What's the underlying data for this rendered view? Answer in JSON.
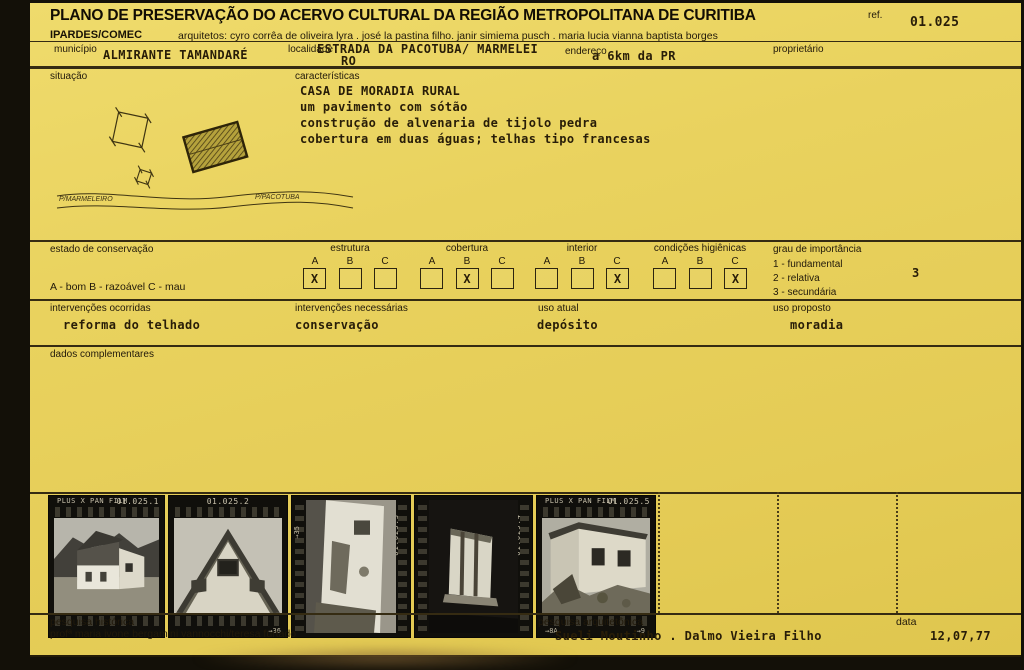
{
  "header": {
    "title": "PLANO DE PRESERVAÇÃO DO ACERVO CULTURAL DA REGIÃO METROPOLITANA DE CURITIBA",
    "org": "IPARDES/COMEC",
    "architects": "arquitetos: cyro corrêa de oliveira lyra . josé la pastina filho. janir simiema pusch . maria lucia vianna baptista borges",
    "ref_label": "ref.",
    "ref_value": "01.025"
  },
  "identification": {
    "municipio_label": "município",
    "municipio_value": "ALMIRANTE TAMANDARÉ",
    "localidade_label": "localidade",
    "localidade_value_line1": "ESTRADA DA PACOTUBA/ MARMELEI",
    "localidade_value_line2": "RO",
    "endereco_label": "endereço",
    "endereco_value": "a 6km da PR",
    "proprietario_label": "proprietário"
  },
  "situacao": {
    "label": "situação",
    "road_label_left": "P/MARMELEIRO",
    "road_label_right": "P/PACOTUBA"
  },
  "caracteristicas": {
    "label": "características",
    "lines": [
      "CASA DE MORADIA RURAL",
      "um pavimento com sótão",
      "construção de alvenaria de tijolo pedra",
      "cobertura em duas águas; telhas tipo francesas"
    ]
  },
  "conservation": {
    "section_label": "estado de conservação",
    "legend": "A - bom    B - razoável    C - mau",
    "options": [
      "A",
      "B",
      "C"
    ],
    "check_mark": "X",
    "groups": [
      {
        "name": "estrutura",
        "checked": "A"
      },
      {
        "name": "cobertura",
        "checked": "B"
      },
      {
        "name": "interior",
        "checked": "C"
      },
      {
        "name": "condições higiênicas",
        "checked": "C"
      }
    ],
    "importance": {
      "label": "grau de importância",
      "items": [
        "1 - fundamental",
        "2 - relativa",
        "3 - secundária"
      ],
      "value": "3"
    }
  },
  "interventions": {
    "occurred_label": "intervenções ocorridas",
    "occurred_value": "reforma do telhado",
    "needed_label": "intervenções necessárias",
    "needed_value": "conservação",
    "current_use_label": "uso atual",
    "current_use_value": "depósito",
    "proposed_use_label": "uso proposto",
    "proposed_use_value": "moradia"
  },
  "complementary": {
    "label": "dados complementares"
  },
  "photos": [
    {
      "label": "01.025.1",
      "film_text": "PLUS X PAN FILM"
    },
    {
      "label": "01.025.2",
      "mark_right": "→36"
    },
    {
      "label": "01.025.3",
      "edge_mark": "→35"
    },
    {
      "label": "01.025.4"
    },
    {
      "label": "01.025.5",
      "film_text": "PLUS X PAN FILM",
      "mark_left": "→8A",
      "mark_right": "→9"
    }
  ],
  "footer": {
    "hist_label": "pesquisa histórica",
    "hist_value": "profª maria ivone bergamini vannocchi/teresa furtado",
    "arch_label": "pesquisa arquitetônica",
    "arch_value": "Sueli Moutinho . Dalmo Vieira Filho",
    "date_label": "data",
    "date_value": "12,07,77"
  }
}
